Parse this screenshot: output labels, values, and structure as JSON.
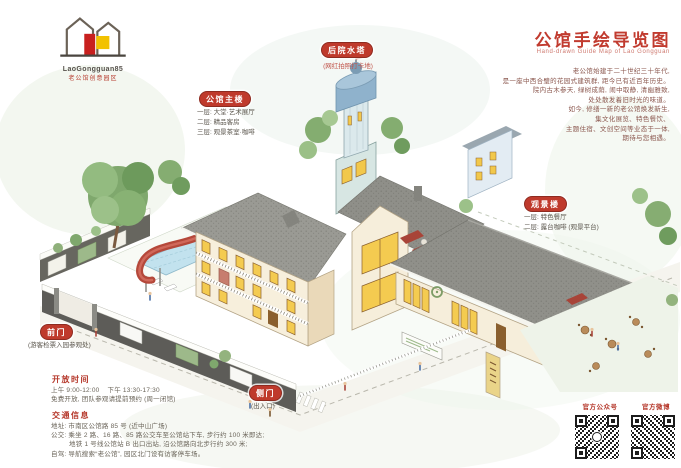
{
  "logo": {
    "en": "LaoGongguan85",
    "cn": "老公馆创意园区"
  },
  "title": {
    "cn": "公馆手绘导览图",
    "en": "Hand-drawn Guide Map of Lao Gongguan",
    "color": "#c13b2f"
  },
  "intro": {
    "lines": [
      "老公馆始建于二十世纪三十年代,",
      "是一座中西合璧的花园式建筑群, 距今已有近百年历史。",
      "院内古木参天, 绿树成荫, 闹中取静, 清幽雅致,",
      "处处散发着旧时光的味道。",
      "如今, 修缮一新的老公馆焕发新生,",
      "集文化展览、特色餐饮、",
      "主题住宿、文创空间等业态于一体,",
      "期待与您相遇。"
    ]
  },
  "labels": {
    "main": {
      "badge": "公馆主楼",
      "lines": [
        "一层: 大堂·艺术展厅",
        "二层: 精品客房",
        "三层: 观景茶室·咖啡"
      ]
    },
    "tower": {
      "badge": "后院水塔",
      "caption": "(网红拍照打卡地)"
    },
    "view": {
      "badge": "观景楼",
      "lines": [
        "一层: 特色餐厅",
        "二层: 露台咖啡 (观景平台)"
      ]
    },
    "front_gate": {
      "badge": "前门",
      "caption": "(游客检票入园参观处)"
    },
    "side_gate": {
      "badge": "侧门",
      "caption": "(出入口)"
    }
  },
  "info": {
    "hours": {
      "heading": "开放时间",
      "lines": [
        "上午 9:00-12:00    下午 13:30-17:30",
        "免费开放, 团队参观请提前预约 (周一闭馆)"
      ]
    },
    "traffic": {
      "heading": "交通信息",
      "lines": [
        "地址: 市南区公馆路 85 号 (近中山广场)",
        "公交: 乘坐 2 路、16 路、85 路公交车至公馆站下车, 步行约 100 米即达;",
        "         地铁 1 号线公馆站 B 出口出站, 沿公馆路向北步行约 300 米;",
        "自驾: 导航搜索“老公馆”, 园区北门设有访客停车场。"
      ]
    }
  },
  "qr": {
    "left_label": "官方公众号",
    "right_label": "官方微博"
  },
  "colors": {
    "badge_red": "#bf3a2c",
    "roof_grey": "#95958f",
    "wall_cream": "#f6eedb",
    "window_yellow": "#f2c84b",
    "tree_green": "#86ad72",
    "pool_blue": "#c2e2ee",
    "stone_wall": "#5d5c58"
  }
}
